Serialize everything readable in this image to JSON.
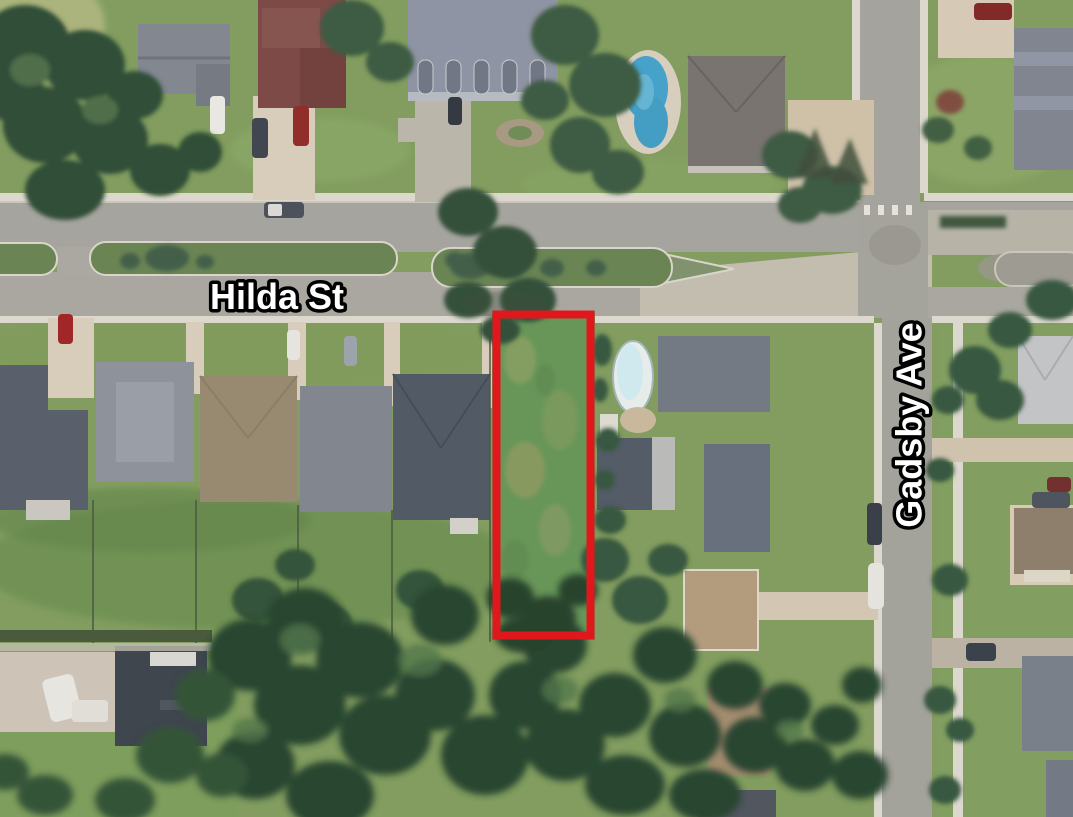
{
  "map": {
    "type": "aerial-satellite-photo",
    "description": "Aerial satellite view of a suburban residential neighborhood; a narrow vacant grass lot on the south side of Hilda St west of Gadsby Ave is outlined in red",
    "labels": {
      "hilda": "Hilda St",
      "gadsby": "Gadsby Ave"
    },
    "streets": [
      {
        "name": "Hilda St",
        "orientation": "horizontal",
        "label_color": "#ffffff",
        "label_outline": "#000000"
      },
      {
        "name": "Gadsby Ave",
        "orientation": "vertical",
        "label_color": "#ffffff",
        "label_outline": "#000000"
      }
    ],
    "highlight": {
      "name": "vacant-lot-outline",
      "shape": "rectangle",
      "color": "#e0181c",
      "description": "Red rectangle outlining the vacant grass lot"
    },
    "scene_features": "houses, driveways, lawns, tree canopy, road medians, swimming pools, parked cars"
  }
}
